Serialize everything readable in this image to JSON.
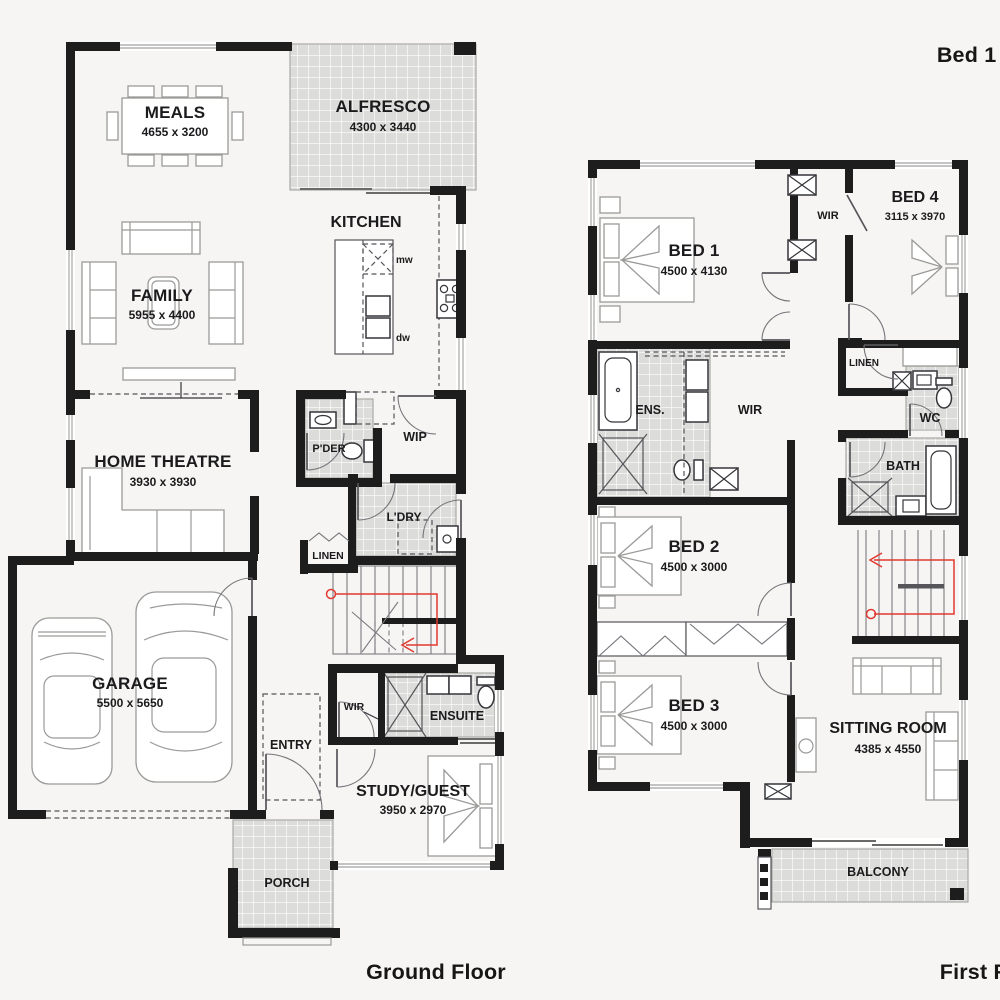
{
  "titles": {
    "top_right": "Bed 1 Rear",
    "ground_floor": "Ground Floor",
    "first_floor": "First Floor"
  },
  "colors": {
    "background": "#f6f5f3",
    "wall": "#1d1d1e",
    "tile": "#dcdcda",
    "tile_grid": "#ffffff",
    "furniture_outline": "#9a9a98",
    "fixture_outline": "#35353a",
    "stair_route": "#e0392f",
    "text": "#1b1b1d"
  },
  "ground_floor": {
    "meals": {
      "label": "MEALS",
      "dim": "4655 x 3200"
    },
    "alfresco": {
      "label": "ALFRESCO",
      "dim": "4300 x 3440"
    },
    "kitchen": {
      "label": "KITCHEN"
    },
    "family": {
      "label": "FAMILY",
      "dim": "5955 x 4400"
    },
    "home_theatre": {
      "label": "HOME THEATRE",
      "dim": "3930 x 3930"
    },
    "powder": {
      "label": "P'DER"
    },
    "pantry": {
      "label": "WIP"
    },
    "laundry": {
      "label": "L'DRY"
    },
    "linen": {
      "label": "LINEN"
    },
    "garage": {
      "label": "GARAGE",
      "dim": "5500 x 5650"
    },
    "entry": {
      "label": "ENTRY"
    },
    "wir": {
      "label": "WIR"
    },
    "ensuite": {
      "label": "ENSUITE"
    },
    "study_guest": {
      "label": "STUDY/GUEST",
      "dim": "3950 x 2970"
    },
    "porch": {
      "label": "PORCH"
    },
    "appliances": {
      "microwave": "mw",
      "dishwasher": "dw"
    }
  },
  "first_floor": {
    "bed1": {
      "label": "BED 1",
      "dim": "4500 x 4130"
    },
    "bed4": {
      "label": "BED 4",
      "dim": "3115 x 3970"
    },
    "wir_hall": {
      "label": "WIR"
    },
    "ensuite": {
      "label": "ENS."
    },
    "wir_bed1": {
      "label": "WIR"
    },
    "linen": {
      "label": "LINEN"
    },
    "wc": {
      "label": "WC"
    },
    "bath": {
      "label": "BATH"
    },
    "bed2": {
      "label": "BED 2",
      "dim": "4500 x 3000"
    },
    "bed3": {
      "label": "BED 3",
      "dim": "4500 x 3000"
    },
    "sitting_room": {
      "label": "SITTING ROOM",
      "dim": "4385 x 4550"
    },
    "balcony": {
      "label": "BALCONY"
    }
  }
}
